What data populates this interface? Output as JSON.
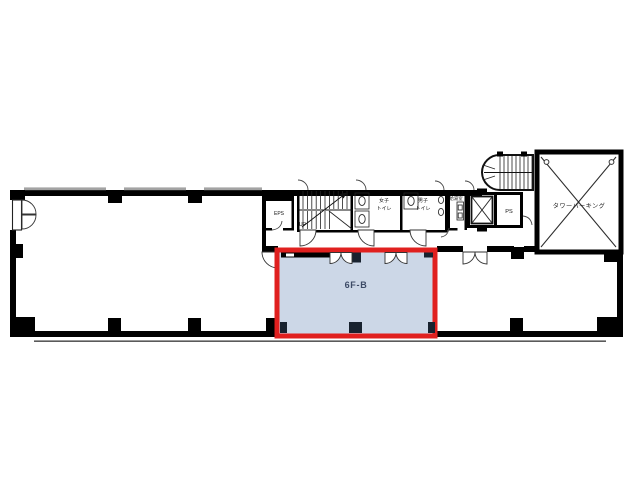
{
  "floor_plan": {
    "unit": {
      "label": "6F-B"
    },
    "rooms": {
      "eps": {
        "label": "EPS"
      },
      "stairwell": {
        "direction_label": "UP"
      },
      "womens_toilet": {
        "line1": "女子",
        "line2": "トイレ"
      },
      "mens_toilet": {
        "line1": "男子",
        "line2": "トイレ"
      },
      "kitchenette": {
        "label": "給湯室"
      },
      "ps": {
        "label": "PS"
      },
      "tower_parking": {
        "label": "タワーパーキング"
      }
    },
    "colors": {
      "wall": "#000000",
      "window_gray": "#a3a3a3",
      "highlight_border": "#e0201f",
      "highlight_fill": "#ccd7e7",
      "label_text": "#3c4a66",
      "background": "#ffffff"
    }
  }
}
